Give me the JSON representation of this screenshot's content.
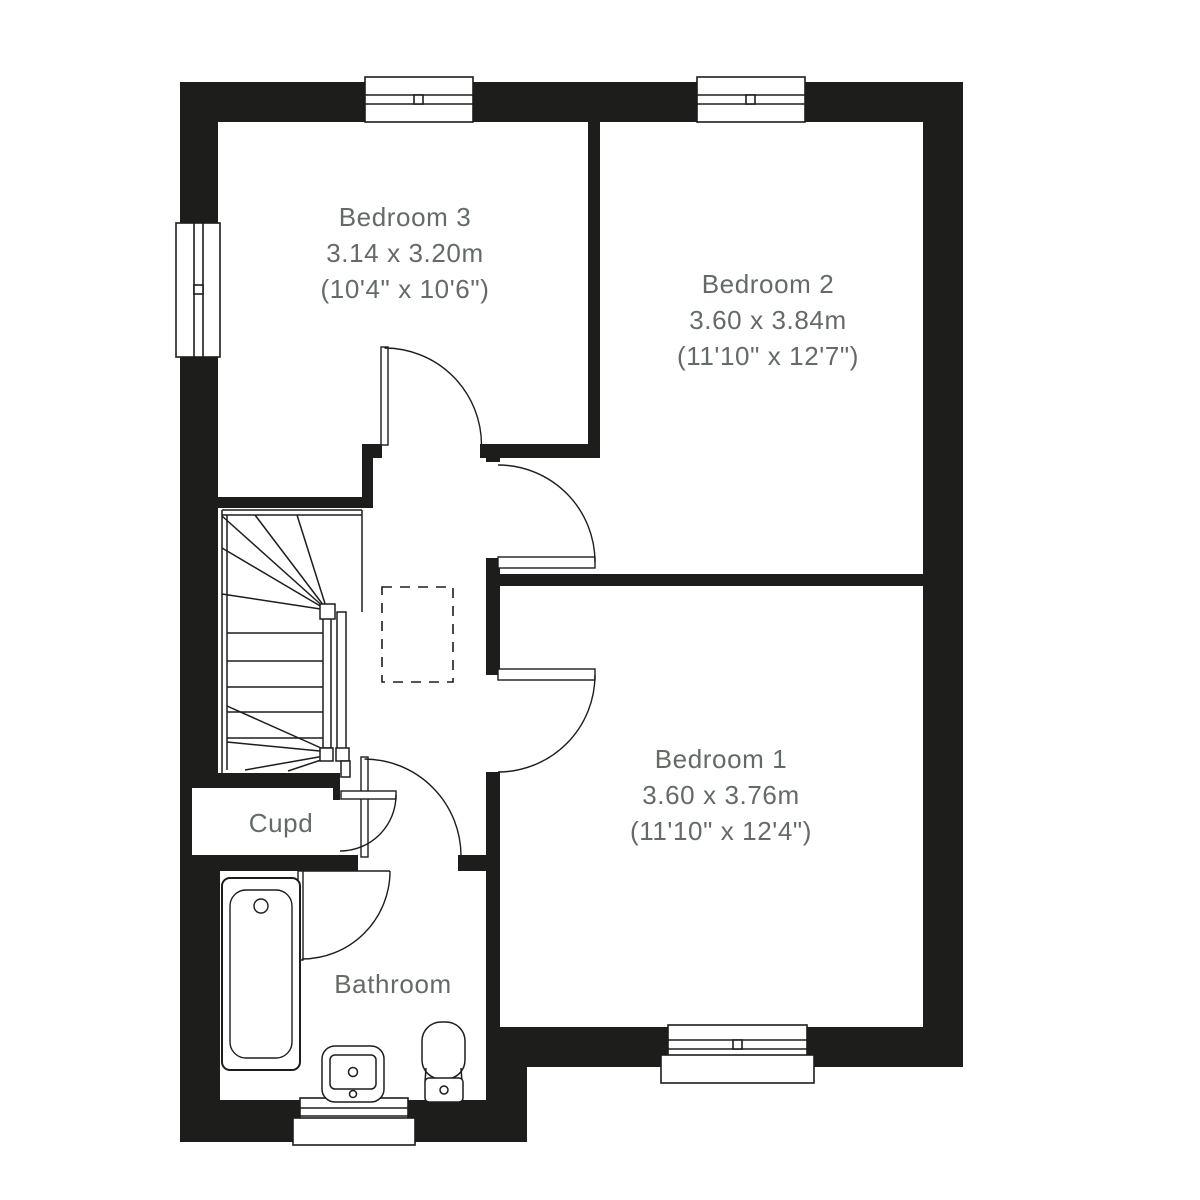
{
  "canvas": {
    "background": "#ffffff",
    "wall_color": "#1d1d1b",
    "line_color": "#1d1d1b",
    "label_color": "#646b66"
  },
  "rooms": [
    {
      "id": "bedroom-3",
      "label": "Bedroom 3",
      "size_metric": "3.14 x 3.20m",
      "size_imperial": "(10'4\" x 10'6\")"
    },
    {
      "id": "bedroom-2",
      "label": "Bedroom 2",
      "size_metric": "3.60 x 3.84m",
      "size_imperial": "(11'10\" x 12'7\")"
    },
    {
      "id": "bedroom-1",
      "label": "Bedroom 1",
      "size_metric": "3.60 x 3.76m",
      "size_imperial": "(11'10\" x 12'4\")"
    },
    {
      "id": "cupboard",
      "label": "Cupd"
    },
    {
      "id": "bathroom",
      "label": "Bathroom"
    }
  ],
  "fixtures": [
    "bath",
    "basin",
    "toilet",
    "winder-stairs",
    "loft-hatch"
  ],
  "window_count": 5,
  "door_count": 5
}
